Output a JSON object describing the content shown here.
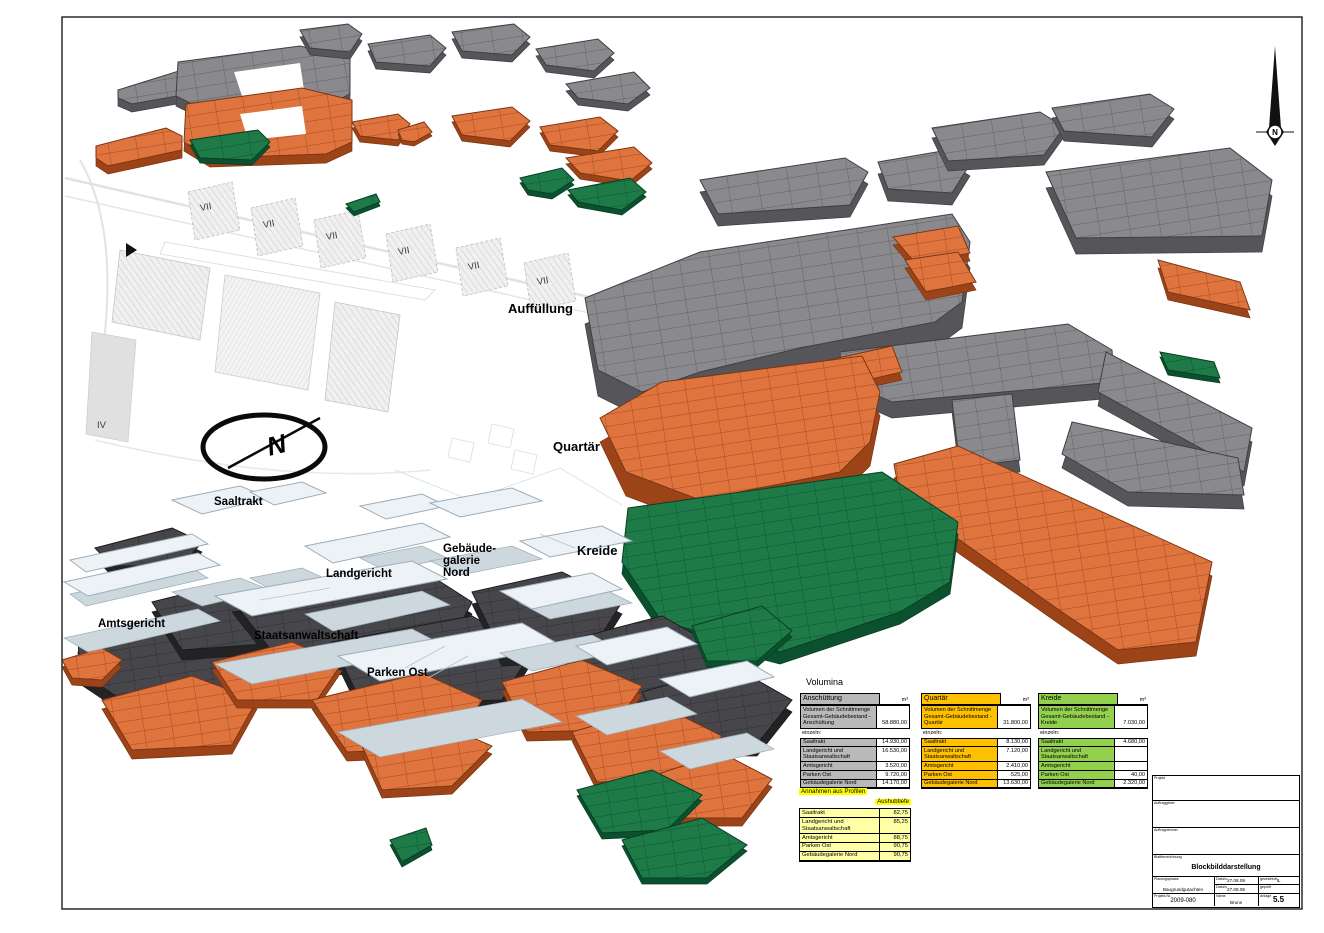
{
  "strata_labels": {
    "auffuellung": "Auffüllung",
    "quartaer": "Quartär",
    "kreide": "Kreide"
  },
  "building_labels": {
    "saaltrakt": "Saaltrakt",
    "landgericht": "Landgericht",
    "gebaeudegalerie": "Gebäude-\ngalerie\nNord",
    "amtsgericht": "Amtsgericht",
    "staatsanwaltschaft": "Staatsanwaltschaft",
    "parken_ost": "Parken Ost"
  },
  "site_plan": {
    "zones": [
      "VII",
      "VII",
      "VII",
      "VII",
      "VII",
      "VII"
    ],
    "block_iv": "IV",
    "north_letter": "N",
    "compass_letter": "N"
  },
  "colors": {
    "anschuettung_gray": "#b9b9b9",
    "quartaer_gold": "#ffc000",
    "kreide_green": "#92d04e",
    "strata_gray": "#8a8a8e",
    "strata_orange": "#e0743f",
    "strata_green": "#1e7a47",
    "strata_dark": "#47474b",
    "highlight_yellow": "#ffff00",
    "pale_yellow": "#ffffa6"
  },
  "volumina": {
    "heading": "Volumina",
    "unit": "m³",
    "einzeln_label": "einzeln:",
    "tables": [
      {
        "title": "Anschüttung",
        "total_label": "Volumen der Schnittmenge Gesamt-Gebäudebestand - Anschüttung",
        "total": "58.880,00",
        "rows": [
          {
            "label": "Saaltrakt",
            "value": "14.930,00"
          },
          {
            "label": "Landgericht und Staatsanwaltschaft",
            "value": "16.530,00"
          },
          {
            "label": "Amtsgericht",
            "value": "3.520,00"
          },
          {
            "label": "Parken Ost",
            "value": "9.720,00"
          },
          {
            "label": "Gebäudegalerie Nord",
            "value": "14.170,00"
          }
        ]
      },
      {
        "title": "Quartär",
        "total_label": "Volumen der Schnittmenge Gesamt-Gebäudebestand - Quartär",
        "total": "31.800,00",
        "rows": [
          {
            "label": "Saaltrakt",
            "value": "8.130,00"
          },
          {
            "label": "Landgericht und Staatsanwaltschaft",
            "value": "7.120,00"
          },
          {
            "label": "Amtsgericht",
            "value": "2.410,00"
          },
          {
            "label": "Parken Ost",
            "value": "525,00"
          },
          {
            "label": "Gebäudegalerie Nord",
            "value": "13.630,00"
          }
        ]
      },
      {
        "title": "Kreide",
        "total_label": "Volumen der Schnittmenge Gesamt-Gebäudebestand - Kreide",
        "total": "7.030,00",
        "rows": [
          {
            "label": "Saaltrakt",
            "value": "4.680,00"
          },
          {
            "label": "Landgericht und Staatsanwaltschaft",
            "value": ""
          },
          {
            "label": "Amtsgericht",
            "value": ""
          },
          {
            "label": "Parken Ost",
            "value": "40,00"
          },
          {
            "label": "Gebäudegalerie Nord",
            "value": "2.320,00"
          }
        ]
      }
    ]
  },
  "annahmen": {
    "title": "Annahmen aus Profilen",
    "col_header": "Aushubtiefe",
    "rows": [
      {
        "label": "Saaltrakt",
        "value": "82,75"
      },
      {
        "label": "Landgericht und Staatsanwaltschaft",
        "value": "85,25"
      },
      {
        "label": "Amtsgericht",
        "value": "88,75"
      },
      {
        "label": "Parken Ost",
        "value": "90,75"
      },
      {
        "label": "Gebäudegalerie Nord",
        "value": "90,75"
      }
    ]
  },
  "titleblock": {
    "projekt_label": "Projekt",
    "auftraggeber_label": "Auftraggeber",
    "auftragnehmer_label": "Auftragnehmer",
    "blattbezeichnung_label": "Blattbezeichnung",
    "blattbezeichnung": "Blockbilddarstellung",
    "planungsphase_label": "Planungsphase",
    "planungsphase": "Baugrundgutachten",
    "datum_label": "Datum",
    "datum1": "27.08.09",
    "datum2": "27.08.09",
    "gezeichnet_label": "gezeichnet",
    "gezeichnet": "IL",
    "geprueft_label": "geprüft",
    "geprueft": "",
    "projekt_nr_label": "Projekt-Nr.",
    "projekt_nr": "2009-080",
    "name_label": "Name",
    "name": "Bruns",
    "anlage_label": "Anlage",
    "anlage": "5.5"
  }
}
